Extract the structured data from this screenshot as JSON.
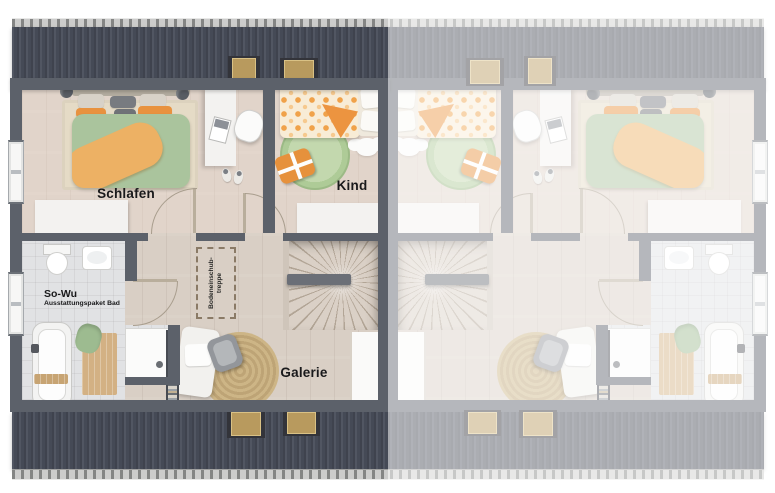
{
  "floorplan": {
    "rooms": {
      "schlafen": {
        "label": "Schlafen"
      },
      "kind": {
        "label": "Kind"
      },
      "galerie": {
        "label": "Galerie"
      },
      "bad": {
        "title": "So-Wu",
        "subtitle": "Ausstattungspaket Bad"
      },
      "treppe": {
        "line1": "Bodeneinschub-",
        "line2": "treppe"
      }
    },
    "colors": {
      "roof": "#454a55",
      "roof_edge": "#cbcbc9",
      "wall": "#5c616a",
      "wood_floor": "#d9cfc5",
      "tile_floor": "#e1e2e4",
      "accent_orange": "#ec9440",
      "accent_green": "#aac49d",
      "rug_jute": "#bba06f",
      "fade_overlay": "rgba(255,255,255,0.55)"
    }
  }
}
